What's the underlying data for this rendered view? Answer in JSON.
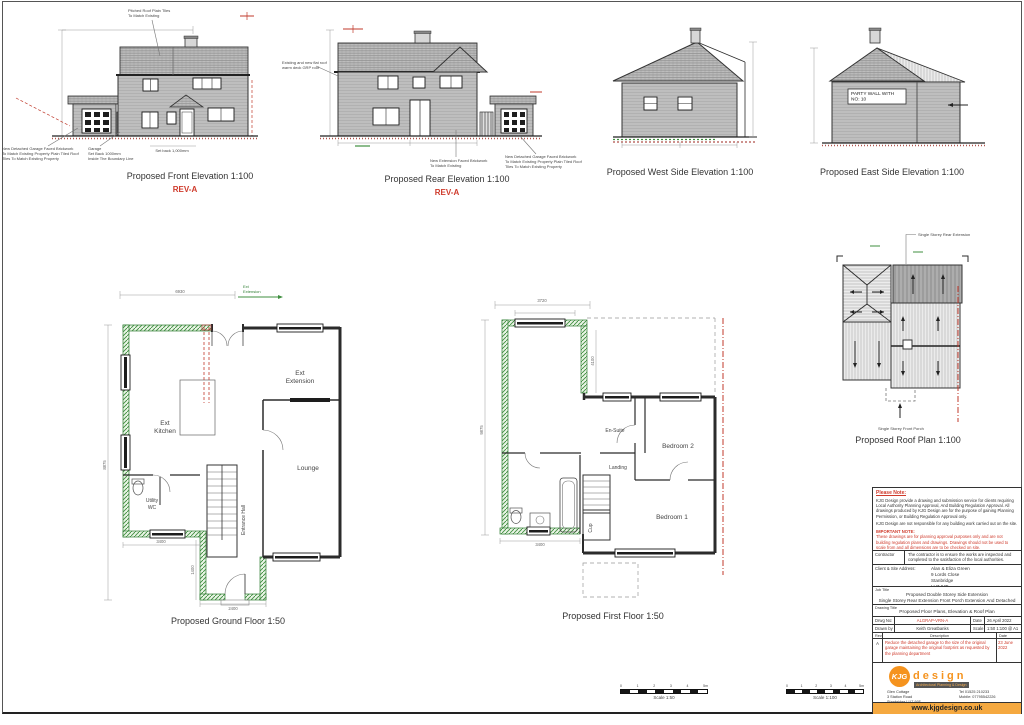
{
  "elevations": {
    "front": {
      "caption": "Proposed Front Elevation 1:100",
      "rev": "REV-A",
      "roof_note": [
        "Pitched Roof Plain Tiles",
        "To Match Existing"
      ],
      "garage_note": [
        "New Detached Garage Faced Brickwork",
        "To Match Existing Property Plain Tiled Roof",
        "Tiles To Match Existing Property"
      ],
      "setback_note": [
        "Garage",
        "Set Back 1000mm",
        "Inside The Boundary Line"
      ],
      "setback_note2": "Set back 1,000mm"
    },
    "rear": {
      "caption": "Proposed Rear Elevation 1:100",
      "rev": "REV-A",
      "grp_note": [
        "Existing and new flat roof",
        "warm deck GRP roof"
      ],
      "extension_note": [
        "New Extension Faced Brickwork",
        "To Match Existing"
      ],
      "garage_note": [
        "New Detached Garage Faced Brickwork",
        "To Match Existing Property Plain Tiled Roof",
        "Tiles To Match Existing Property"
      ]
    },
    "west": {
      "caption": "Proposed West Side Elevation 1:100"
    },
    "east": {
      "caption": "Proposed East Side Elevation 1:100",
      "party_wall": [
        "PARTY WALL WITH",
        "NO: 10"
      ]
    }
  },
  "ground_floor": {
    "caption": "Proposed Ground Floor 1:50",
    "rooms": {
      "kitchen": [
        "Ext",
        "Kitchen"
      ],
      "extension": [
        "Ext",
        "Extension"
      ],
      "lounge": "Lounge",
      "utility": [
        "Utility",
        "WC"
      ],
      "hall": "Entrance Hall"
    },
    "dims": {
      "top": "6930",
      "left": "8875",
      "bottom": "3400",
      "porch": "2400",
      "porch_side": "1400"
    },
    "ext_arrow": [
      "Ext",
      "Extension"
    ]
  },
  "first_floor": {
    "caption": "Proposed First Floor 1:50",
    "rooms": {
      "ensuite": "En-Suite",
      "bedroom2": "Bedroom 2",
      "landing": "Landing",
      "bedroom1": "Bedroom 1",
      "cup": "Cup"
    },
    "dims": {
      "top": "3720",
      "left": "9875",
      "mid": "4100",
      "bottom": "3400"
    }
  },
  "roof_plan": {
    "caption": "Proposed Roof Plan 1:100",
    "note_top": "Single Storey Rear Extension",
    "note_bottom": "Single Storey Front Porch"
  },
  "title_block": {
    "please_note_heading": "Please Note:",
    "note_1": "KJG Design provide a drawing and submission service for clients requiring Local Authority Planning Approval, And Building Regulation Approval. All drawings produced by KJG Design are for the purpose of gaining Planning Permission, or Building Regulation Approval only.",
    "note_2": "KJG Design are not responsible for any building work carried out on the site.",
    "important_heading": "IMPORTANT NOTE:",
    "important_text": "These drawings are for planning approval purposes only and are not building regulation plans and drawings. Drawings should not be used to scale from and all dimensions are to be checked on site.",
    "contractor_label": "Contractor",
    "contractor_text": "The contractor is to ensure the works are inspected and completed to the satisfaction of the local authorities.",
    "client_label": "Client & Site Address:",
    "client_lines": [
      "Alan & Eliza Green",
      "9 Lords Close",
      "Stanbridge",
      "LU7 9JT"
    ],
    "job_label": "Job Title",
    "job_title_1": "Proposed Double Storey Side Extension",
    "job_title_2": "Single Storey Rear Extension Front Porch Extension And Detached Garage",
    "drawing_title_label": "Drawing Title",
    "drawing_title": "Proposed Floor Plans, Elevation & Roof Plan",
    "drwg_no_label": "Drwg No:",
    "drwg_no": "ALGRAP-VRN-A",
    "date_label": "Date",
    "date": "26 April 2022",
    "drawn_by_label": "Drawn by",
    "drawn_by": "Keith Greatbanks",
    "scale_label": "Scale",
    "scale": "1:50 1:100 @ A1",
    "rev_col_label": "Rev",
    "desc_col_label": "Description",
    "date_col_label": "Date",
    "rev_letter": "A",
    "rev_description": "Reduce the detached garage to the size of the original garage maintaining the original footprint as requested by the planning department",
    "rev_date": "23 June 2022",
    "logo": {
      "kjg": "KJG",
      "design": "design",
      "tagline": "Architectural Planning & Design"
    },
    "office_lines": [
      "Glen Cottage",
      "3 Station Road",
      "Stanbridge LU7 9JF"
    ],
    "contact_lines": [
      "Tel 01525 210233",
      "Mobile: 07795542226"
    ],
    "website": "www.kjgdesign.co.uk"
  },
  "scale_bars": [
    {
      "label": "Scale 1:50",
      "ticks": [
        "0",
        "1",
        "2",
        "3",
        "4",
        "5m"
      ]
    },
    {
      "label": "Scale 1:100",
      "ticks": [
        "0",
        "1",
        "2",
        "3",
        "4",
        "5m"
      ]
    }
  ],
  "colors": {
    "accent_orange": "#f5931e",
    "rev_red": "#cf3a2b",
    "new_wall_green": "#3f8f3f",
    "boundary_red": "#b23a3a"
  }
}
